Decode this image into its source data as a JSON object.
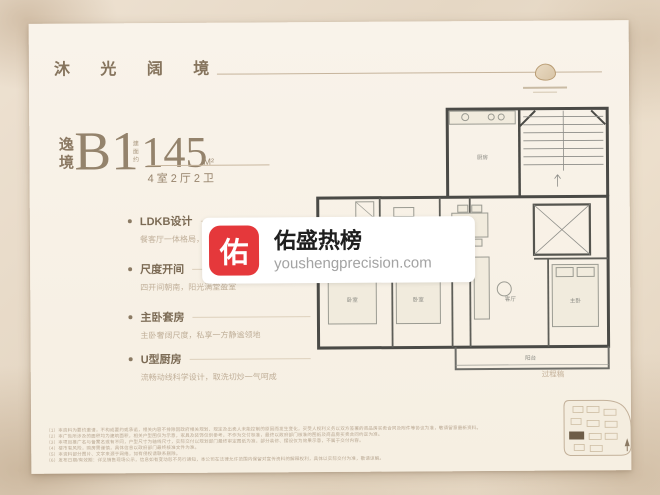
{
  "header": {
    "brand_title": "沐 光 阔 境"
  },
  "unit": {
    "series_vertical": "逸境",
    "unit_code": "B1",
    "area_prefix": "建面约",
    "area_value": "145",
    "area_unit": "M²",
    "layout": "4室2厅2卫"
  },
  "features": [
    {
      "title": "LDKB设计",
      "desc": "餐客厅一体格局，南向阔景生活场"
    },
    {
      "title": "尺度开间",
      "desc": "四开间朝南，阳光满堂盈室"
    },
    {
      "title": "主卧套房",
      "desc": "主卧奢阔尺度，私享一方静谧领地"
    },
    {
      "title": "U型厨房",
      "desc": "流畅动线科学设计，取洗切炒一气呵成"
    }
  ],
  "watermark": {
    "icon_char": "佑",
    "title": "佑盛热榜",
    "url": "youshengprecision.com",
    "icon_color": "#e5383b"
  },
  "floorplan": {
    "draft_label": "过程稿",
    "rooms": [
      "厨房",
      "餐厅",
      "客厅",
      "主卧",
      "卧室",
      "卧室",
      "阳台"
    ]
  },
  "disclaimer": {
    "lines": [
      "（1）本资料为要约邀请，不构成要约或承诺，相关内容不排除因政府相关规划、规定及出卖人未能控制的原因而发生变化，买受人权利义务以双方签署的商品房买卖合同及附件等协议为准，敬请留意最新资料。",
      "（2）本广告所涉及的面积均为建筑面积，相关户型图仅为示意，家具及装饰仅供参考，不作为交付标准，最终以政府部门核准的图纸及商品房买卖合同约定为准。",
      "（3）本项目推广名与备案名或有不同，户型尺寸为轴线尺寸，实际交付以规划部门最终审定图纸为准，部分装修、摆设仅为效果示意，不属于交付内容。",
      "（4）楼市有风险，购房需谨慎，具体信息以政府部门最终核准文件为准。",
      "（5）本资料部分图片、文字来源于网络，如有侵权请联系删除。",
      "（6）发布日期/有效期：详见销售现场公示，信息如有变动恕不另行通知，本公司在法律允许范围内保留对宣传资料的解释权利，具体以实际交付为准，敬请谅解。"
    ]
  }
}
